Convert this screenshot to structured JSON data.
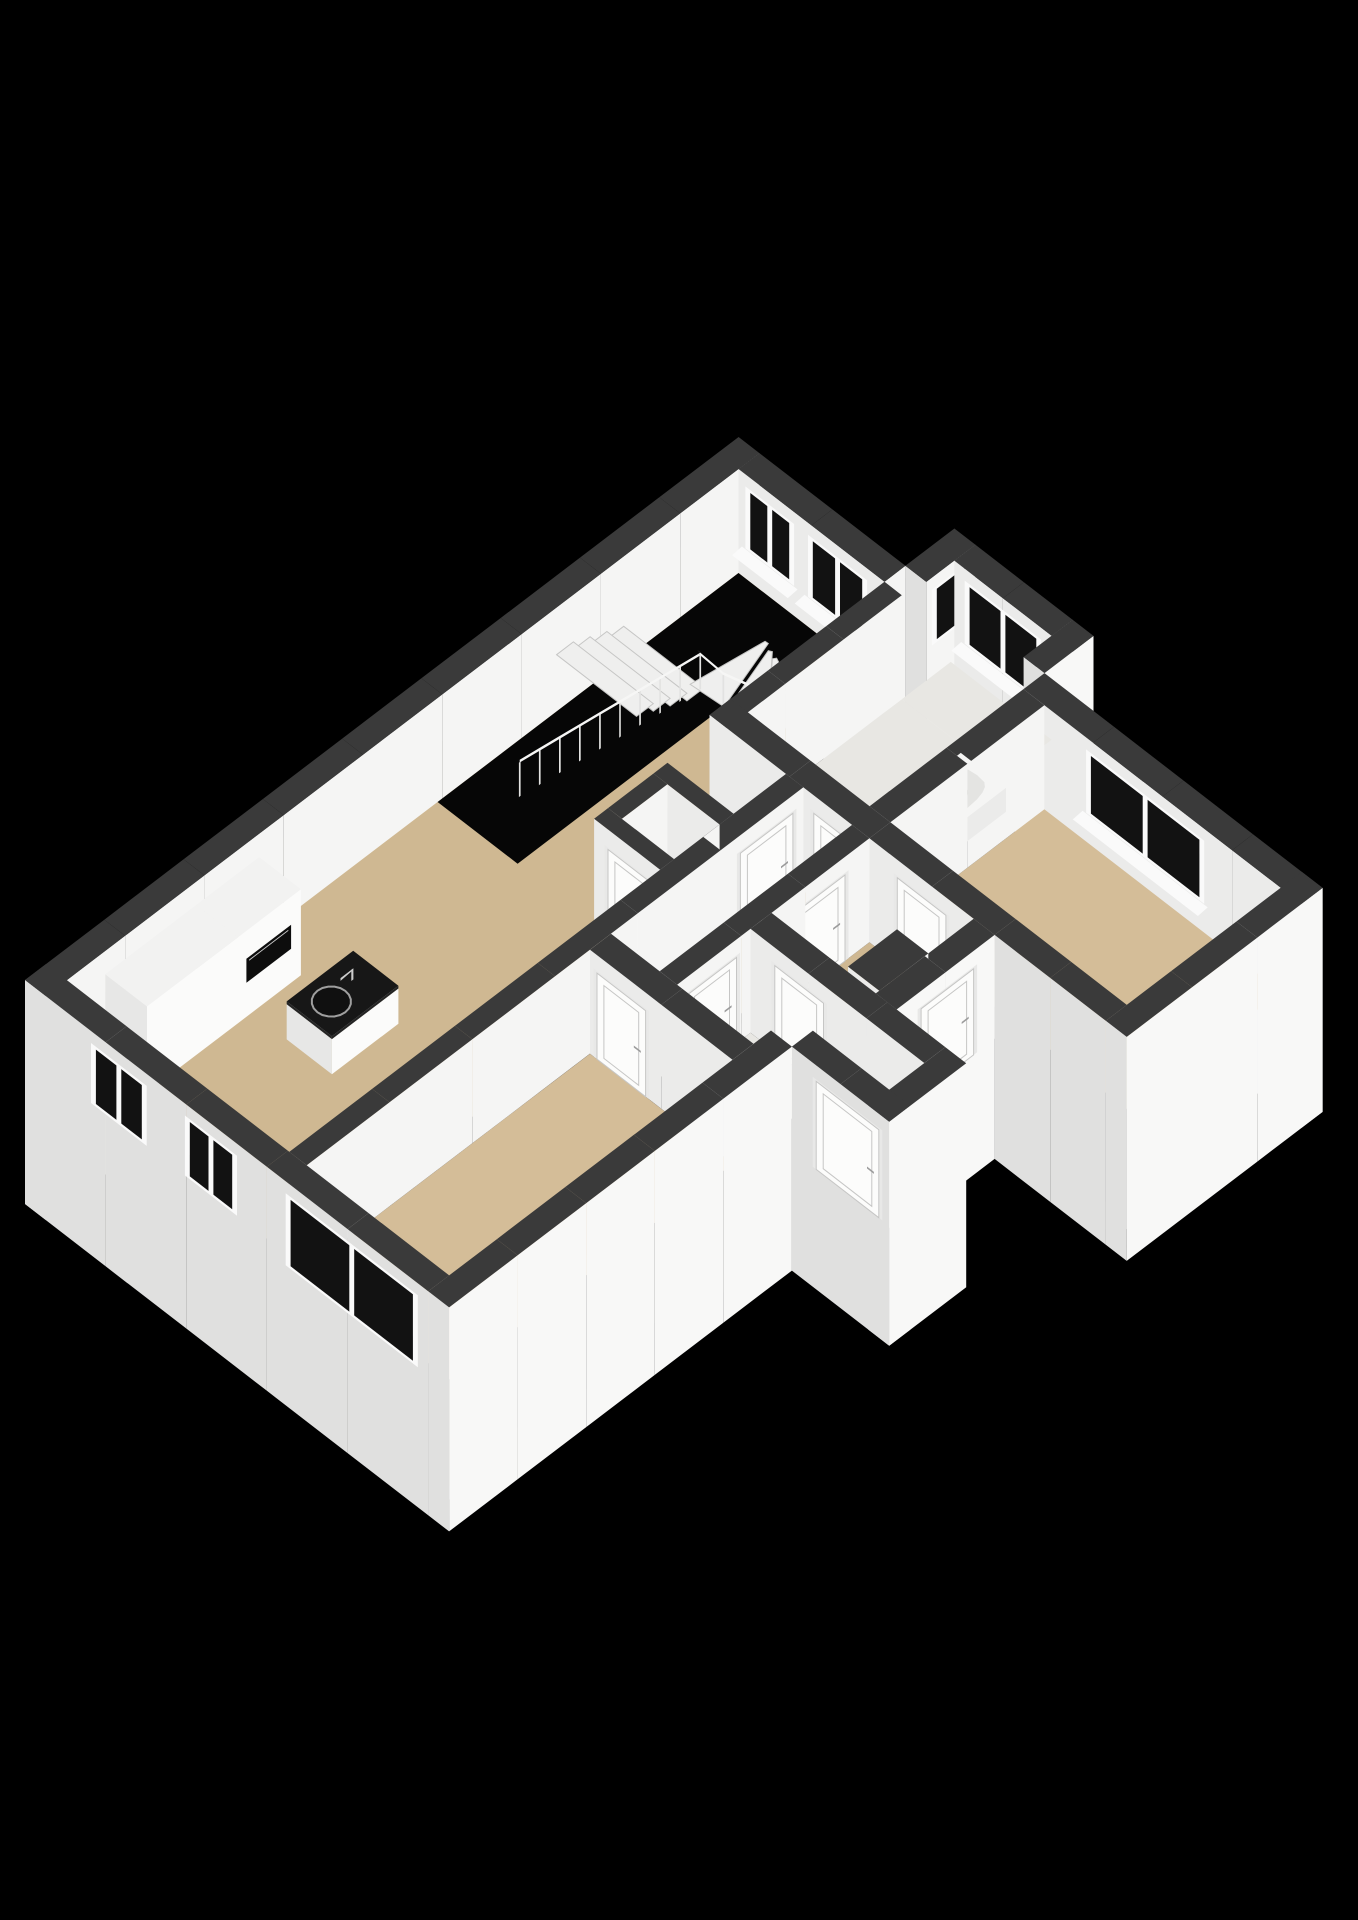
{
  "meta": {
    "view": "3d-floor-plan-isometric",
    "description": "Cut-away 3D floor plan of an apartment on black background; white walls with dark grey tops, tan wood floors, grey tile in bathroom and vestibule, staircase void along the far wall, kitchen cabinets and island with sink, bathtub in bathroom bay, multiple interior doors and windows. No visible text in the image."
  },
  "canvas": {
    "width": 1358,
    "height": 1920,
    "background": "#000000"
  },
  "scene": {
    "projection": {
      "origin_x": 25,
      "origin_y": 1084,
      "scale": 88,
      "ex": [
        0.795,
        -0.605
      ],
      "ey": [
        0.79,
        0.61
      ],
      "z_px_per_m": 40
    },
    "palette": {
      "wall_top": "#3a3a3a",
      "face_se": "#f8f8f7",
      "face_sw": "#e0e0df",
      "face_int_se": "#f5f5f4",
      "face_int_sw": "#ebebea",
      "floor_tan": "#cfb892",
      "floor_tan2": "#d4bd98",
      "floor_light": "#e8e7e3",
      "glass": "#121212",
      "frame": "#fafafa",
      "void": "#060606",
      "tread": "#efefee",
      "tread_edge": "#c6c6c5",
      "rail": "#f6f6f5",
      "post": "#e2e2e1",
      "counter_top": "#171717",
      "counter_top_side": "#242424",
      "cab_top": "#f2f2f1",
      "cab_sw": "#e7e7e6",
      "cab_se": "#fbfbfa",
      "oven": "#0d0d0d",
      "chrome": "#cccccc",
      "steel": "#9f9f9f",
      "tub_top": "#f5f5f4",
      "tub_inner": "#e4e4e2",
      "tub_inner2": "#d7d7d5",
      "tub_side": "#ebebea",
      "door_leaf": "#fcfcfb",
      "door_frame": "#e8e8e7",
      "door_edge": "#c6c6c5",
      "handle": "#9c9c9c"
    },
    "walls_back": [
      {
        "name": "envelope-nw",
        "u": [
          0,
          10.2
        ],
        "v": [
          0,
          0.3
        ],
        "z": [
          -3,
          2.6
        ],
        "fse": "face_int_se",
        "fsw": "face_sw"
      },
      {
        "name": "envelope-ne-living",
        "u": [
          9.9,
          10.2
        ],
        "v": [
          0.3,
          2.4
        ],
        "z": [
          -3,
          2.6
        ],
        "fsw": "face_int_sw",
        "fse": "face_int_se"
      },
      {
        "name": "bay-side-nw",
        "u": [
          10.2,
          10.9
        ],
        "v": [
          2.4,
          2.7
        ],
        "z": [
          -3,
          2.6
        ],
        "fse": "face_int_se",
        "fsw": "face_sw"
      },
      {
        "name": "bay-front-ne",
        "u": [
          10.6,
          10.9
        ],
        "v": [
          2.7,
          4.1
        ],
        "z": [
          -3,
          2.6
        ],
        "fsw": "face_int_sw",
        "fse": "face_int_se"
      },
      {
        "name": "bay-side-se",
        "u": [
          10.2,
          10.9
        ],
        "v": [
          4.1,
          4.4
        ],
        "z": [
          -3,
          2.6
        ],
        "fse": "face_se",
        "fsw": "face_sw"
      },
      {
        "name": "envelope-ne-bedroom",
        "u": [
          9.9,
          10.2
        ],
        "v": [
          4.4,
          8.4
        ],
        "z": [
          -3,
          2.6
        ],
        "fsw": "face_int_sw",
        "fse": "face_se"
      }
    ],
    "windows_back": [
      {
        "name": "living-window-1",
        "wall": "envelope-ne-living",
        "plane": "u",
        "at": 9.9,
        "range": [
          0.4,
          1.1
        ],
        "z": [
          0.75,
          2.3
        ],
        "panes": 2,
        "sill": true,
        "sillDir": -1
      },
      {
        "name": "living-window-2",
        "wall": "envelope-ne-living",
        "plane": "u",
        "at": 9.9,
        "range": [
          1.3,
          2.15
        ],
        "z": [
          0.75,
          2.3
        ],
        "panes": 2,
        "sill": true,
        "sillDir": -1
      },
      {
        "name": "stair-step-window",
        "wall": "bay-side-nw",
        "plane": "v",
        "at": 2.7,
        "range": [
          10.28,
          10.82
        ],
        "z": [
          0.9,
          2.3
        ],
        "panes": 1,
        "sill": false,
        "sillDir": 1
      },
      {
        "name": "bathroom-bay-window",
        "wall": "bay-front-ne",
        "plane": "u",
        "at": 10.6,
        "range": [
          2.85,
          3.95
        ],
        "z": [
          0.72,
          2.3
        ],
        "panes": 2,
        "sill": true,
        "sillDir": -1
      },
      {
        "name": "bedroom-right-window",
        "wall": "envelope-ne-bedroom",
        "plane": "u",
        "at": 9.9,
        "range": [
          5.3,
          7.0
        ],
        "z": [
          0.72,
          2.3
        ],
        "panes": 2,
        "sill": true,
        "sillDir": -1
      }
    ],
    "floors": [
      {
        "name": "floor-living-kitchen",
        "color": "floor_tan",
        "pts": [
          [
            0.3,
            0.3
          ],
          [
            9.9,
            0.3
          ],
          [
            9.9,
            2.4
          ],
          [
            7.4,
            2.4
          ],
          [
            7.4,
            3.5
          ],
          [
            0.3,
            3.5
          ]
        ]
      },
      {
        "name": "floor-bathroom",
        "color": "floor_light",
        "pts": [
          [
            7.7,
            2.65
          ],
          [
            9.9,
            2.65
          ],
          [
            9.9,
            4.4
          ],
          [
            7.7,
            4.4
          ]
        ]
      },
      {
        "name": "floor-bathroom-bay",
        "color": "floor_light",
        "pts": [
          [
            9.9,
            2.65
          ],
          [
            10.6,
            2.65
          ],
          [
            10.6,
            4.1
          ],
          [
            10.2,
            4.1
          ],
          [
            10.2,
            4.4
          ],
          [
            9.9,
            4.4
          ]
        ]
      },
      {
        "name": "floor-bedroom-left",
        "color": "floor_tan2",
        "pts": [
          [
            0.3,
            3.75
          ],
          [
            4.35,
            3.75
          ],
          [
            4.35,
            5.8
          ],
          [
            0.3,
            5.8
          ]
        ]
      },
      {
        "name": "floor-corridor",
        "color": "floor_tan",
        "pts": [
          [
            4.65,
            3.75
          ],
          [
            7.4,
            3.75
          ],
          [
            7.4,
            4.45
          ],
          [
            4.65,
            4.45
          ]
        ]
      },
      {
        "name": "floor-vestibule",
        "color": "floor_light",
        "pts": [
          [
            4.65,
            4.7
          ],
          [
            5.7,
            4.7
          ],
          [
            5.7,
            7.2
          ],
          [
            5.2,
            7.2
          ],
          [
            5.2,
            5.8
          ],
          [
            4.65,
            5.8
          ]
        ]
      },
      {
        "name": "floor-hall",
        "color": "floor_tan",
        "pts": [
          [
            6.0,
            4.7
          ],
          [
            7.4,
            4.7
          ],
          [
            7.4,
            6.2
          ],
          [
            6.0,
            6.2
          ]
        ]
      },
      {
        "name": "floor-closet",
        "color": "floor_light",
        "pts": [
          [
            5.8,
            2.75
          ],
          [
            6.45,
            2.75
          ],
          [
            6.45,
            3.5
          ],
          [
            5.8,
            3.5
          ]
        ]
      },
      {
        "name": "floor-bedroom-right",
        "color": "floor_tan2",
        "pts": [
          [
            7.7,
            4.7
          ],
          [
            9.9,
            4.7
          ],
          [
            9.9,
            8.1
          ],
          [
            7.7,
            8.1
          ]
        ]
      }
    ],
    "stairs": {
      "void": [
        [
          5.6,
          0.3
        ],
        [
          9.9,
          0.3
        ],
        [
          9.9,
          1.45
        ],
        [
          5.6,
          1.45
        ]
      ],
      "straight": {
        "u_start": 8.26,
        "n": 4,
        "w": 0.24,
        "v": [
          0.3,
          1.45
        ],
        "z_start": 0.85,
        "dz": 0.19
      },
      "fan": {
        "pivot": [
          9.3,
          1.4
        ],
        "r0": 0.1,
        "r1": 1.05,
        "a0": 88,
        "a1": 188,
        "n": 4,
        "z": [
          0.14,
          0.32,
          0.5,
          0.68
        ]
      },
      "rail": {
        "v": 1.36,
        "u": [
          5.72,
          8.3
        ],
        "z": [
          2.32,
          1.56
        ],
        "posts": 10,
        "drop": 0.92,
        "fan_r": 1.0,
        "fan_a": [
          185,
          85
        ],
        "fan_samples": 6,
        "fan_z_end": 0.9,
        "newel_z": 0.98
      }
    },
    "walls_sorted": [
      {
        "name": "bathroom-nw",
        "u": [
          7.4,
          9.9
        ],
        "v": [
          2.4,
          2.65
        ],
        "z": [
          0,
          2.6
        ]
      },
      {
        "name": "closet-west",
        "u": [
          5.6,
          5.8
        ],
        "v": [
          2.55,
          3.5
        ],
        "z": [
          0,
          2.6
        ]
      },
      {
        "name": "closet-north",
        "u": [
          5.8,
          6.45
        ],
        "v": [
          2.55,
          2.75
        ],
        "z": [
          0,
          2.6
        ]
      },
      {
        "name": "closet-east",
        "u": [
          6.45,
          6.65
        ],
        "v": [
          2.55,
          3.5
        ],
        "z": [
          0,
          2.6
        ]
      },
      {
        "name": "wall-living-corridor",
        "u": [
          0.3,
          7.4
        ],
        "v": [
          3.5,
          3.75
        ],
        "z": [
          0,
          2.6
        ]
      },
      {
        "name": "wall-bedroomL-vestibule",
        "u": [
          4.35,
          4.65
        ],
        "v": [
          3.75,
          5.8
        ],
        "z": [
          0,
          2.6
        ]
      },
      {
        "name": "bathroom-sw",
        "u": [
          7.4,
          7.7
        ],
        "v": [
          2.4,
          4.7
        ],
        "z": [
          0,
          2.6
        ]
      },
      {
        "name": "bathroom-se",
        "u": [
          7.7,
          9.9
        ],
        "v": [
          4.4,
          4.7
        ],
        "z": [
          0,
          2.6
        ]
      },
      {
        "name": "wall-corridor-se",
        "u": [
          4.65,
          7.4
        ],
        "v": [
          4.45,
          4.7
        ],
        "z": [
          0,
          2.6
        ]
      },
      {
        "name": "wall-vestibule-hall",
        "u": [
          5.7,
          6.0
        ],
        "v": [
          4.7,
          7.2
        ],
        "z": [
          0,
          2.6
        ]
      },
      {
        "name": "bedroomR-sw-upper",
        "u": [
          7.4,
          7.7
        ],
        "v": [
          4.7,
          6.5
        ],
        "z": [
          0,
          2.6
        ]
      },
      {
        "name": "bedroomR-sw-lower",
        "u": [
          7.4,
          7.7
        ],
        "v": [
          6.5,
          8.1
        ],
        "z": [
          -3,
          2.6
        ],
        "ext": true
      },
      {
        "name": "hall-closet-block",
        "u": [
          6.05,
          6.75
        ],
        "v": [
          5.75,
          6.2
        ],
        "z": [
          0,
          2.6
        ]
      },
      {
        "name": "hall-se",
        "u": [
          6.0,
          7.4
        ],
        "v": [
          6.2,
          6.5
        ],
        "z": [
          -3,
          2.6
        ],
        "ext": true
      },
      {
        "name": "vestibule-sw",
        "u": [
          4.9,
          5.2
        ],
        "v": [
          6.1,
          7.5
        ],
        "z": [
          -3,
          2.6
        ],
        "ext": true
      },
      {
        "name": "vestibule-se",
        "u": [
          4.9,
          6.0
        ],
        "v": [
          7.2,
          7.5
        ],
        "z": [
          -3,
          2.6
        ],
        "ext": true
      },
      {
        "name": "bedroomL-se",
        "u": [
          0,
          4.9
        ],
        "v": [
          5.8,
          6.1
        ],
        "z": [
          -3,
          2.6
        ],
        "ext": true
      },
      {
        "name": "envelope-sw",
        "u": [
          0,
          0.3
        ],
        "v": [
          0,
          5.8
        ],
        "z": [
          -3,
          2.6
        ],
        "ext": true
      },
      {
        "name": "bedroomR-se",
        "u": [
          7.4,
          10.2
        ],
        "v": [
          8.1,
          8.4
        ],
        "z": [
          -3,
          2.6
        ],
        "ext": true
      }
    ],
    "panels": [
      {
        "name": "closet-back-panel",
        "plane": "v",
        "at": 3.5,
        "range": [
          5.8,
          6.45
        ],
        "z": [
          0,
          2.6
        ],
        "fill": "face_int_se",
        "key": -2.5
      }
    ],
    "windows_sorted": [
      {
        "name": "kitchen-window-1",
        "plane": "u",
        "at": 0,
        "range": [
          0.95,
          1.75
        ],
        "z": [
          0.8,
          2.3
        ],
        "panes": 2,
        "sill": false,
        "sillDir": -1
      },
      {
        "name": "kitchen-window-2",
        "plane": "u",
        "at": 0,
        "range": [
          2.3,
          3.05
        ],
        "z": [
          0.8,
          2.3
        ],
        "panes": 2,
        "sill": false,
        "sillDir": -1
      },
      {
        "name": "bedroom-left-window",
        "plane": "u",
        "at": 0,
        "range": [
          3.75,
          5.65
        ],
        "z": [
          0.5,
          2.3
        ],
        "panes": 2,
        "sill": false,
        "sillDir": -1
      }
    ],
    "doors": [
      {
        "name": "door-bedroom-left",
        "plane": "u",
        "at": 4.35,
        "range": [
          3.85,
          4.55
        ],
        "z": [
          0,
          2.15
        ]
      },
      {
        "name": "door-living-corridor",
        "plane": "v",
        "at": 3.75,
        "range": [
          6.5,
          7.25
        ],
        "z": [
          0,
          2.15
        ]
      },
      {
        "name": "door-closet",
        "plane": "u",
        "at": 5.6,
        "range": [
          2.75,
          3.35
        ],
        "z": [
          0,
          2.1
        ]
      },
      {
        "name": "door-bathroom",
        "plane": "u",
        "at": 7.4,
        "range": [
          3.9,
          4.6
        ],
        "z": [
          0,
          2.15
        ]
      },
      {
        "name": "door-bedroom-right",
        "plane": "u",
        "at": 7.4,
        "range": [
          5.1,
          5.8
        ],
        "z": [
          0,
          2.15
        ]
      },
      {
        "name": "door-corridor-vestibule",
        "plane": "v",
        "at": 4.7,
        "range": [
          4.8,
          5.5
        ],
        "z": [
          0,
          2.15
        ]
      },
      {
        "name": "door-corridor-hall",
        "plane": "v",
        "at": 4.7,
        "range": [
          6.35,
          7.05
        ],
        "z": [
          0,
          2.15
        ]
      },
      {
        "name": "door-vestibule-hall",
        "plane": "u",
        "at": 5.7,
        "range": [
          5.05,
          5.75
        ],
        "z": [
          0,
          2.15
        ]
      },
      {
        "name": "door-front",
        "plane": "u",
        "at": 4.9,
        "range": [
          6.45,
          7.35
        ],
        "z": [
          0,
          2.2
        ]
      },
      {
        "name": "door-back",
        "plane": "v",
        "at": 6.5,
        "range": [
          6.35,
          7.1
        ],
        "z": [
          0,
          2.15
        ]
      }
    ],
    "kitchen": {
      "cabinets": [
        {
          "name": "kitchen-cabinet-tall-left",
          "u": [
            0.8,
            2.1
          ],
          "v": [
            0.35,
            0.95
          ],
          "z": [
            0,
            2.15
          ]
        },
        {
          "name": "kitchen-cabinet-tall-right",
          "u": [
            2.1,
            3.0
          ],
          "v": [
            0.35,
            0.95
          ],
          "z": [
            0,
            2.15
          ],
          "oven": {
            "u": [
              2.22,
              2.86
            ],
            "z": [
              0.85,
              1.45
            ]
          }
        }
      ],
      "counter": {
        "name": "kitchen-island",
        "u": [
          2.3,
          3.25
        ],
        "v": [
          1.45,
          2.1
        ],
        "z_base": 0.88,
        "z_top": 0.95,
        "sink": {
          "c": [
            2.62,
            1.77
          ],
          "r": 0.2
        },
        "faucet": {
          "p": [
            2.97,
            1.72
          ]
        }
      }
    },
    "bathtub": {
      "name": "bathtub",
      "u": [
        8.0,
        9.6
      ],
      "v": [
        3.8,
        4.45
      ],
      "h": 0.6
    }
  }
}
